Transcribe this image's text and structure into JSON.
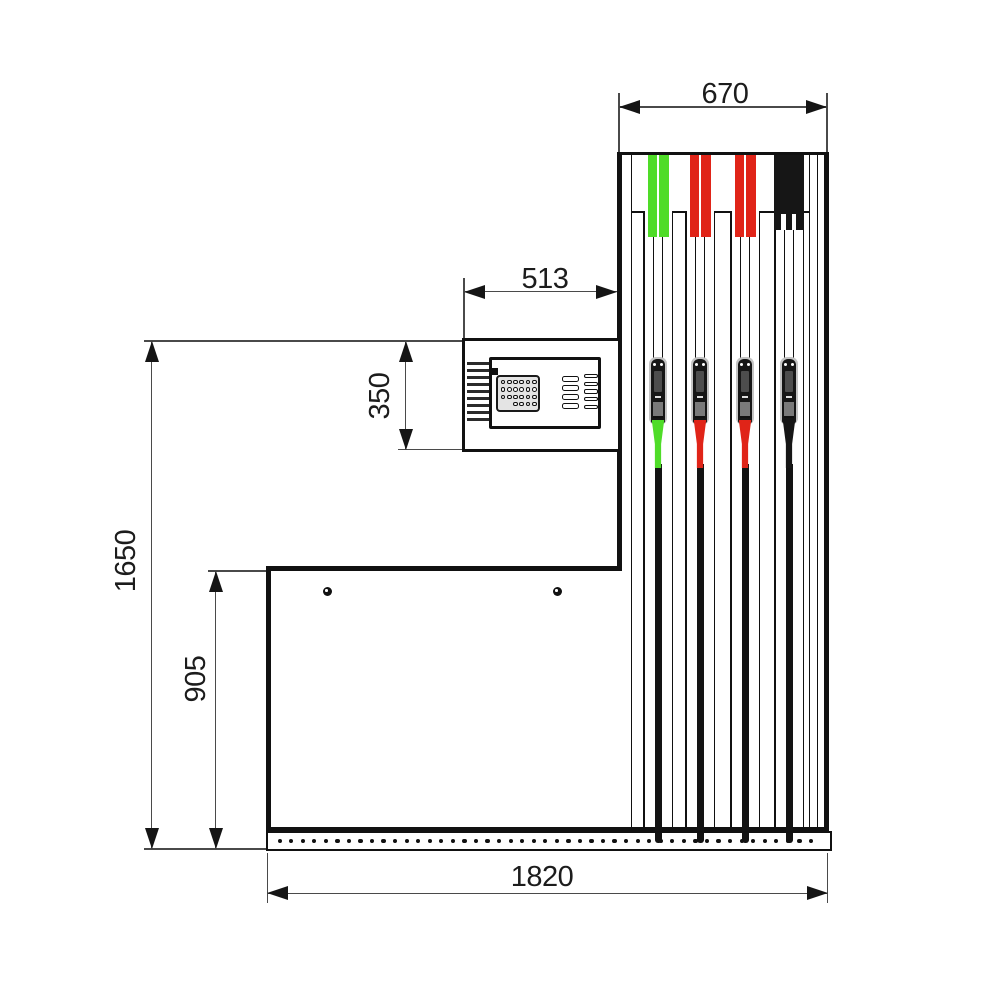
{
  "drawing": {
    "type": "technical-dimension-elevation",
    "subject": "fuel-dispenser-side-view",
    "dimension_labels": {
      "tower_width": "670",
      "head_width": "513",
      "head_height": "350",
      "overall_height": "1650",
      "cabinet_height": "905",
      "base_width": "1820"
    },
    "stations": [
      {
        "name": "hose-1-green",
        "cap_color": "#4fdc28",
        "spout_color": "#4fdc28"
      },
      {
        "name": "hose-2-red",
        "cap_color": "#e02418",
        "spout_color": "#e02418"
      },
      {
        "name": "hose-3-red",
        "cap_color": "#e02418",
        "spout_color": "#e02418"
      },
      {
        "name": "hose-4-black",
        "cap_color": "#161616",
        "spout_color": "#161616"
      }
    ],
    "colors": {
      "object_line": "#111111",
      "dimension_line": "#4a4a4a",
      "text": "#1c1c1c",
      "background": "#ffffff"
    }
  }
}
